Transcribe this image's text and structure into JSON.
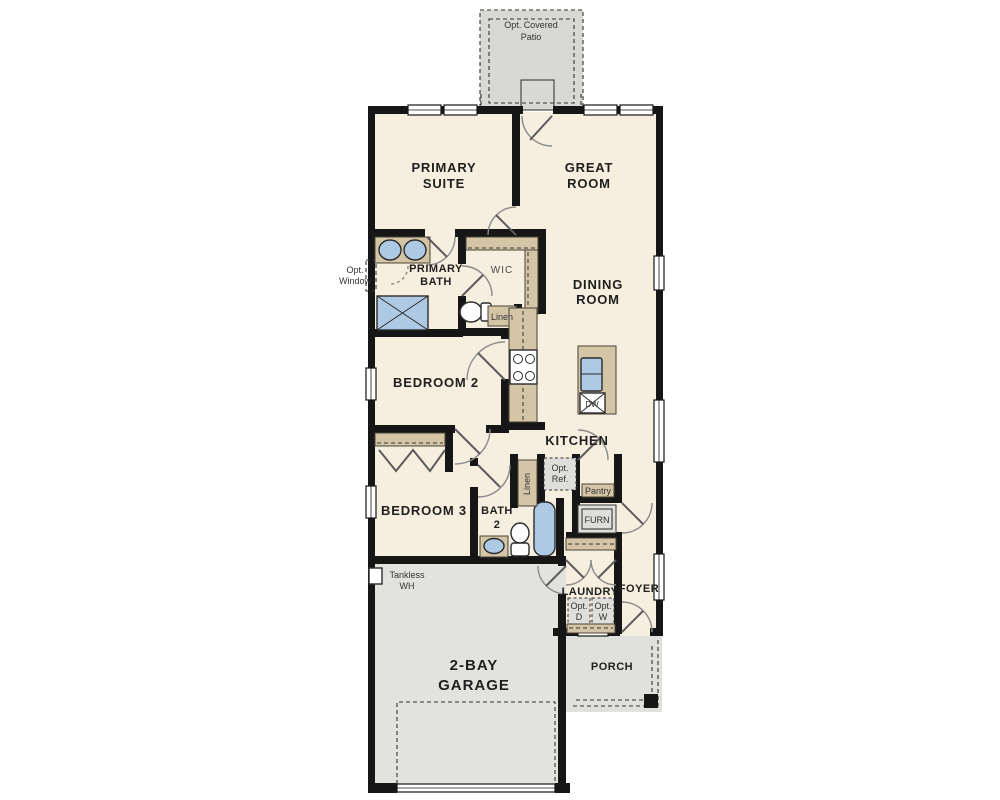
{
  "plan_title": "Single-family floor plan",
  "colors": {
    "wall": "#161616",
    "interior_floor": "#f6eede",
    "patio_concrete": "#d8d8d4",
    "garage_concrete": "#e2e2de",
    "porch_concrete": "#e0e0dc",
    "counter_tan": "#d4c5a7",
    "fixture_blue": "#adc9e3",
    "optional_gray": "#dededa"
  },
  "labels": {
    "patio_l1": "Opt. Covered",
    "patio_l2": "Patio",
    "primary_suite_l1": "PRIMARY",
    "primary_suite_l2": "SUITE",
    "great_room_l1": "GREAT",
    "great_room_l2": "ROOM",
    "primary_bath_l1": "PRIMARY",
    "primary_bath_l2": "BATH",
    "opt_window_l1": "Opt.",
    "opt_window_l2": "Window",
    "wic": "WIC",
    "linen_hall": "Linen",
    "dining_l1": "DINING",
    "dining_l2": "ROOM",
    "bedroom2": "BEDROOM 2",
    "kitchen": "KITCHEN",
    "dw": "DW",
    "bedroom3": "BEDROOM 3",
    "bath2_l1": "BATH",
    "bath2_l2": "2",
    "linen_bath": "Linen",
    "opt_ref_l1": "Opt.",
    "opt_ref_l2": "Ref.",
    "pantry": "Pantry",
    "furn": "FURN",
    "laundry": "LAUNDRY",
    "opt_d_l1": "Opt.",
    "opt_d_l2": "D",
    "opt_w_l1": "Opt.",
    "opt_w_l2": "W",
    "foyer": "FOYER",
    "tankless_l1": "Tankless",
    "tankless_l2": "WH",
    "garage_l1": "2-BAY",
    "garage_l2": "GARAGE",
    "porch": "PORCH"
  }
}
